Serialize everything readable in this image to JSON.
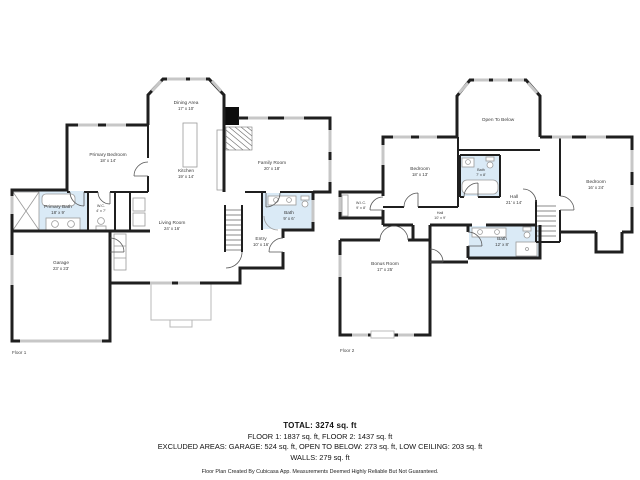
{
  "floor1": {
    "label": "Floor 1",
    "rooms": {
      "dining": {
        "name": "Dining Area",
        "dims": "17' x 10'"
      },
      "primary_bedroom": {
        "name": "Primary Bedroom",
        "dims": "18' x 14'"
      },
      "kitchen": {
        "name": "Kitchen",
        "dims": "19' x 14'"
      },
      "family_room": {
        "name": "Family Room",
        "dims": "20' x 18'"
      },
      "living_room": {
        "name": "Living Room",
        "dims": "24' x 16'"
      },
      "primary_bath": {
        "name": "Primary Bath",
        "dims": "18' x 9'"
      },
      "wc": {
        "name": "W.C.",
        "dims": "4' x 7'"
      },
      "bath": {
        "name": "Bath",
        "dims": "9' x 6'"
      },
      "entry": {
        "name": "Entry",
        "dims": "10' x 16'"
      },
      "garage": {
        "name": "Garage",
        "dims": "23' x 23'"
      }
    }
  },
  "floor2": {
    "label": "Floor 2",
    "rooms": {
      "open_to_below": {
        "name": "Open To Below",
        "dims": ""
      },
      "bedroom_left": {
        "name": "Bedroom",
        "dims": "18' x 13'"
      },
      "bath_upper": {
        "name": "Bath",
        "dims": "7' x 8'"
      },
      "wic": {
        "name": "W.I.C.",
        "dims": "9' x 8'"
      },
      "hall_left": {
        "name": "Hall",
        "dims": "10' x 9'"
      },
      "hall_center": {
        "name": "Hall",
        "dims": "21' x 14'"
      },
      "bedroom_right": {
        "name": "Bedroom",
        "dims": "16' x 24'"
      },
      "bath_lower": {
        "name": "Bath",
        "dims": "12' x 8'"
      },
      "bonus_room": {
        "name": "Bonus Room",
        "dims": "17' x 25'"
      }
    }
  },
  "summary": {
    "total": "TOTAL: 3274 sq. ft",
    "floors": "FLOOR 1: 1837 sq. ft, FLOOR 2: 1437 sq. ft",
    "excluded": "EXCLUDED AREAS: GARAGE: 524 sq. ft, OPEN TO BELOW: 273 sq. ft, LOW CEILING: 203 sq. ft",
    "walls": "WALLS: 279 sq. ft",
    "disclaimer": "Floor Plan Created By Cubicasa App. Measurements Deemed Highly Reliable But Not Guaranteed."
  },
  "colors": {
    "wall": "#1f1f1f",
    "window": "#c7c7c7",
    "bath_fill": "#daeaf6",
    "door": "#555555",
    "background": "#ffffff"
  }
}
